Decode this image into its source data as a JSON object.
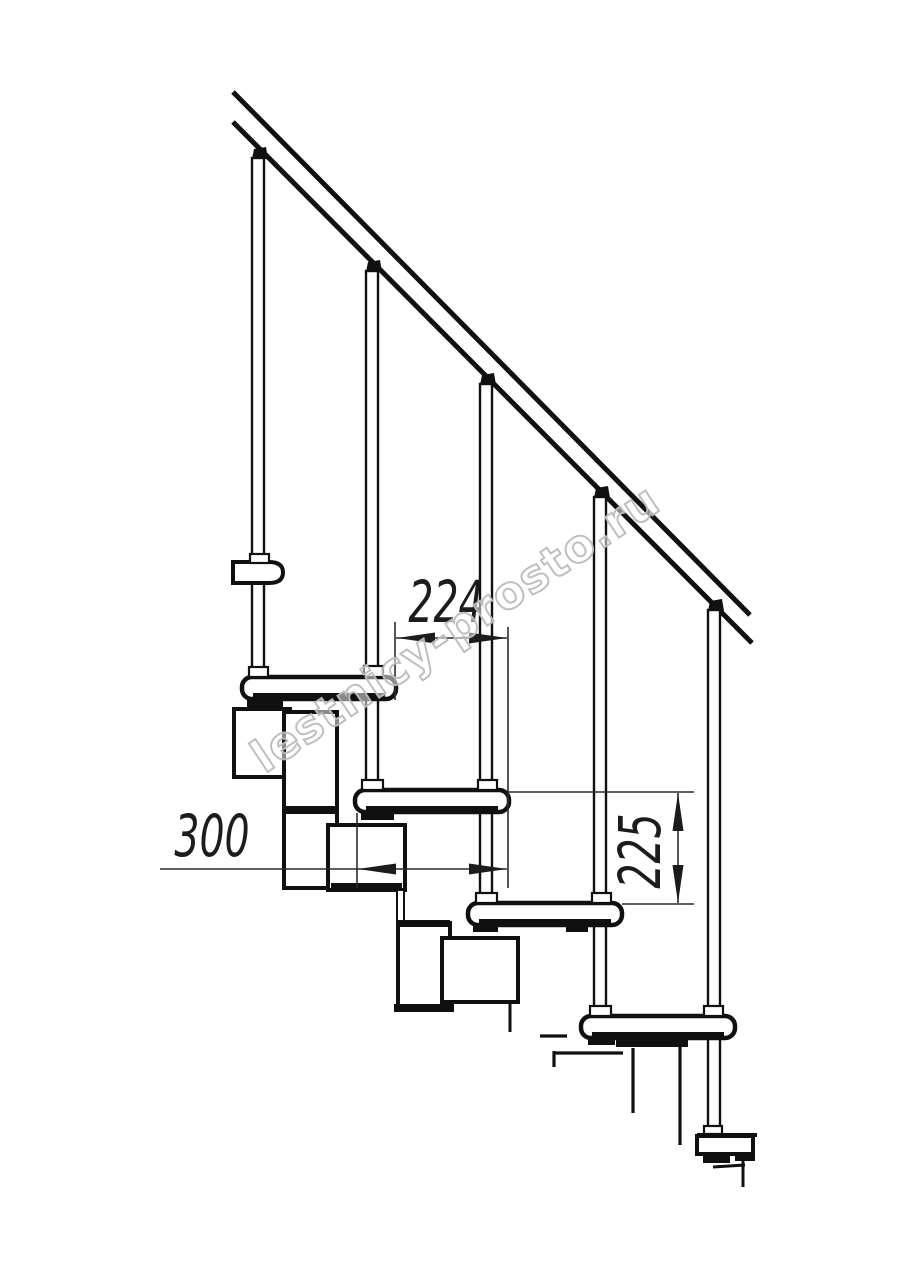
{
  "canvas": {
    "width": 914,
    "height": 1280,
    "background": "#ffffff"
  },
  "drawing": {
    "type": "staircase-side-view-blueprint",
    "stroke_color": "#101010",
    "dim_color": "#2b2b2b",
    "labels": {
      "dim_step_offset": "224",
      "dim_step_depth": "300",
      "dim_step_rise": "225"
    },
    "watermark": {
      "text": "lestnicy-prosto.ru",
      "color": "#bfbfbf"
    }
  }
}
